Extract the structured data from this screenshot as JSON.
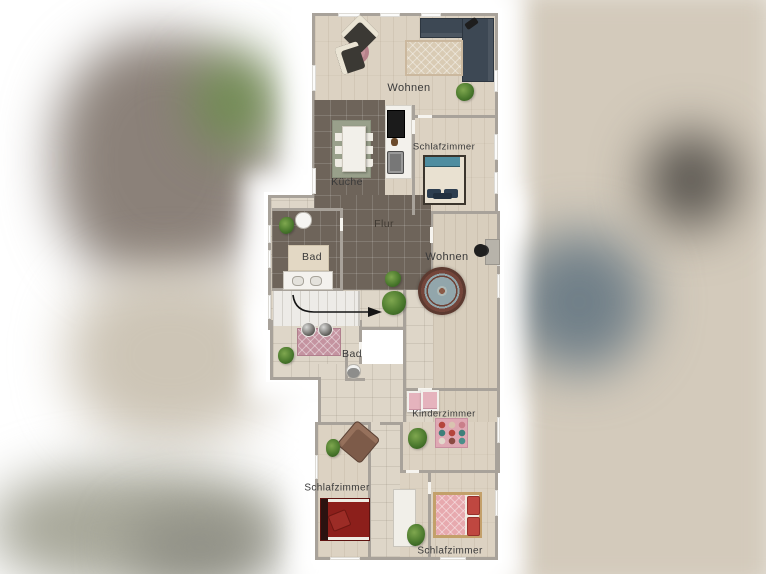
{
  "rooms": [
    {
      "id": "living-top",
      "label": "Wohnen"
    },
    {
      "id": "kitchen",
      "label": "Küche"
    },
    {
      "id": "bedroom-top",
      "label": "Schlafzimmer"
    },
    {
      "id": "hallway",
      "label": "Flur"
    },
    {
      "id": "bath-upper",
      "label": "Bad"
    },
    {
      "id": "living-mid",
      "label": "Wohnen"
    },
    {
      "id": "bath-lower",
      "label": "Bad"
    },
    {
      "id": "kids-room",
      "label": "Kinderzimmer"
    },
    {
      "id": "bedroom-left",
      "label": "Schlafzimmer"
    },
    {
      "id": "bedroom-right",
      "label": "Schlafzimmer"
    }
  ],
  "palette": {
    "wall": "#a8a29a",
    "wood_floor": "#dcd2c2",
    "dark_tile": "#6e645a",
    "light_tile": "#ded6c8",
    "sofa_navy": "#3d4854",
    "bed_teal_stripe": "#4f8da0",
    "bed_red": "#8c1f1b",
    "bed_pink": "#e7a9ae",
    "rug_round_border": "#74453a",
    "rug_round_center": "#92a6ab",
    "rug_pink": "#c493a0",
    "rug_beige": "#d9cbb4",
    "kitchen_rug_sage": "#99a08b",
    "plant_green": "#4c7a2e",
    "arrow_black": "#151515"
  },
  "furniture_icons": [
    "corner-sofa",
    "armchair",
    "round-rug",
    "area-rug",
    "dining-table",
    "dining-chairs",
    "kitchen-counter",
    "stove",
    "oven",
    "double-bed",
    "toilet",
    "washbasin",
    "sink-counter",
    "office-chair",
    "desk",
    "stairs",
    "direction-arrow",
    "potted-plant",
    "dresser",
    "play-rug",
    "wardrobe",
    "lounge-chair",
    "cat"
  ]
}
